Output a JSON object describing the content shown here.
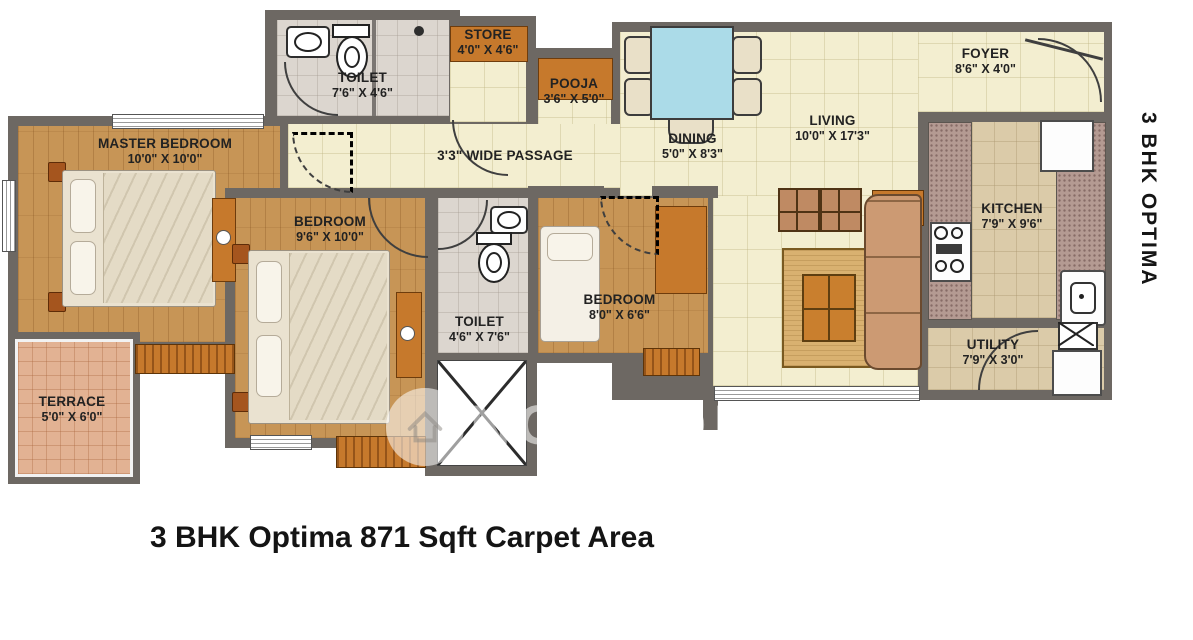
{
  "title": {
    "caption": "3 BHK Optima 871 Sqft Carpet Area",
    "side_label": "3 BHK OPTIMA"
  },
  "watermark": {
    "text": "NOBROKER",
    "registered_mark": "®",
    "logo": "house-in-circle-icon"
  },
  "rooms": {
    "master_bedroom": {
      "name": "MASTER BEDROOM",
      "dims": "10'0\" X 10'0\""
    },
    "toilet_top": {
      "name": "TOILET",
      "dims": "7'6\" X 4'6\""
    },
    "store": {
      "name": "STORE",
      "dims": "4'0\" X 4'6\""
    },
    "pooja": {
      "name": "POOJA",
      "dims": "3'6\" X 5'0\""
    },
    "passage": {
      "label": "3'3\" WIDE PASSAGE"
    },
    "dining": {
      "name": "DINING",
      "dims": "5'0\" X 8'3\""
    },
    "living": {
      "name": "LIVING",
      "dims": "10'0\" X 17'3\""
    },
    "foyer": {
      "name": "FOYER",
      "dims": "8'6\" X 4'0\""
    },
    "kitchen": {
      "name": "KITCHEN",
      "dims": "7'9\" X 9'6\""
    },
    "bedroom_mid": {
      "name": "BEDROOM",
      "dims": "9'6\" X 10'0\""
    },
    "toilet_mid": {
      "name": "TOILET",
      "dims": "4'6\" X 7'6\""
    },
    "bedroom_right": {
      "name": "BEDROOM",
      "dims": "8'0\" X 6'6\""
    },
    "utility": {
      "name": "UTILITY",
      "dims": "7'9\" X 3'0\""
    },
    "terrace": {
      "name": "TERRACE",
      "dims": "5'0\" X 6'0\""
    }
  },
  "colors": {
    "wall": "#6d6863",
    "wood_floor": "#c79556",
    "living_floor": "#f3eed0",
    "toilet_floor": "#dcd6cf",
    "kitchen_floor": "#dbcba9",
    "counter_granite": "#b49a92",
    "terrace_tile": "#e2b293",
    "accent_orange": "#c6792c",
    "table_blue": "#abdbe8",
    "label_text": "#222222"
  }
}
